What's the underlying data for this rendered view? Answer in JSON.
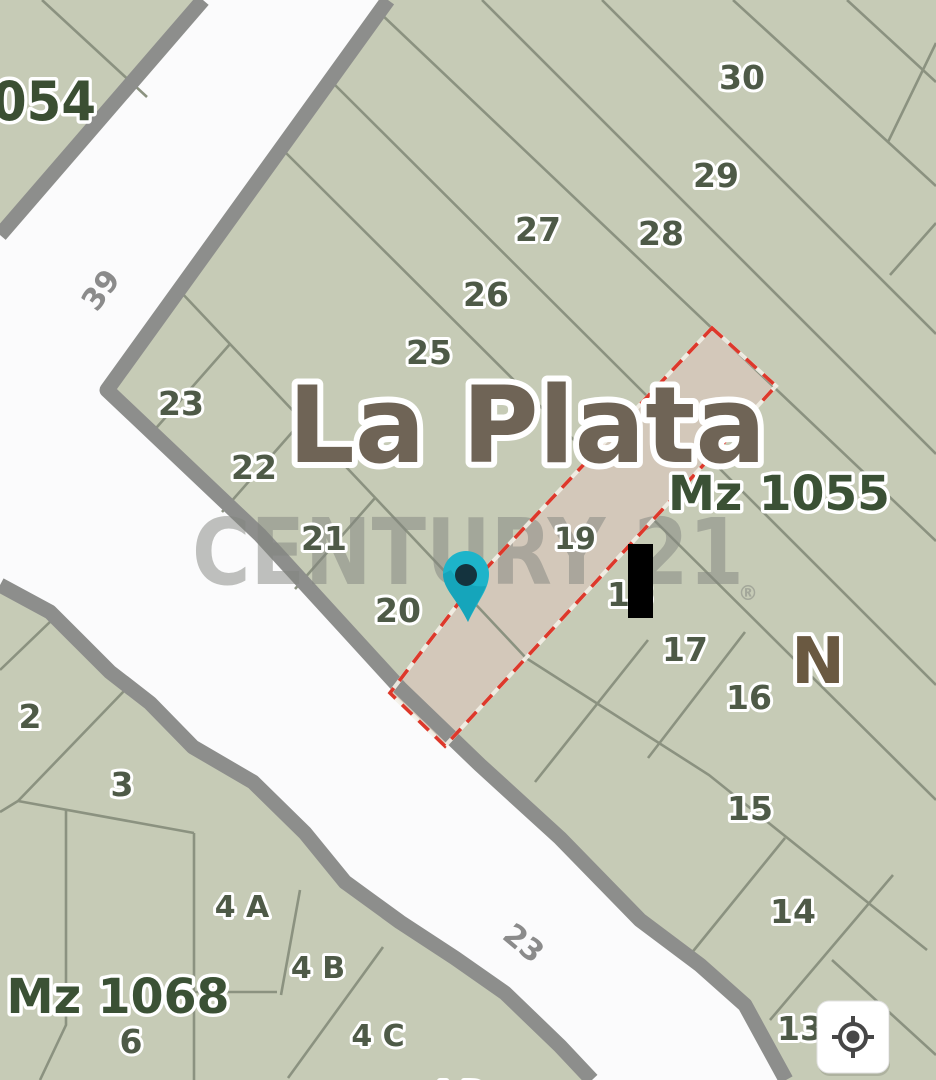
{
  "map": {
    "city_label": "La Plata",
    "north_label": "N",
    "blocks": {
      "b1054_partial": "054",
      "b1055": "Mz 1055",
      "b1068": "Mz 1068"
    },
    "streets": {
      "s39": "39",
      "s23": "23"
    },
    "lots": {
      "l30": "30",
      "l29": "29",
      "l28": "28",
      "l27": "27",
      "l26": "26",
      "l25": "25",
      "l23": "23",
      "l22": "22",
      "l21": "21",
      "l20": "20",
      "l19": "19",
      "l18": "18",
      "l17": "17",
      "l16": "16",
      "l15": "15",
      "l14": "14",
      "l13": "13",
      "l2": "2",
      "l3": "3",
      "l4a": "4 A",
      "l4b": "4 B",
      "l4c": "4 C",
      "l4d": "4 D",
      "l6": "6"
    },
    "watermark": {
      "text": "CENTURY 21",
      "registered": "®"
    },
    "selected_parcel": {
      "outline_color": "#dd382b",
      "fill_color": "#d3c8ba"
    },
    "pin": {
      "color": "#1db4ca",
      "dot_color": "#14333e"
    }
  },
  "controls": {
    "locate_button_icon": "crosshair-locate-icon"
  },
  "colors": {
    "parcel_fill": "#c6cbb6",
    "road_fill": "#fbfbfc",
    "road_border": "#8d8e8c",
    "lot_line": "#8b9280",
    "lot_number_text": "#4e5a47",
    "block_label_text": "#3b5135",
    "city_label_text": "#6f6456",
    "north_text": "#6a5941",
    "street_text": "#8b8b8b",
    "watermark_text": "#82857f"
  }
}
